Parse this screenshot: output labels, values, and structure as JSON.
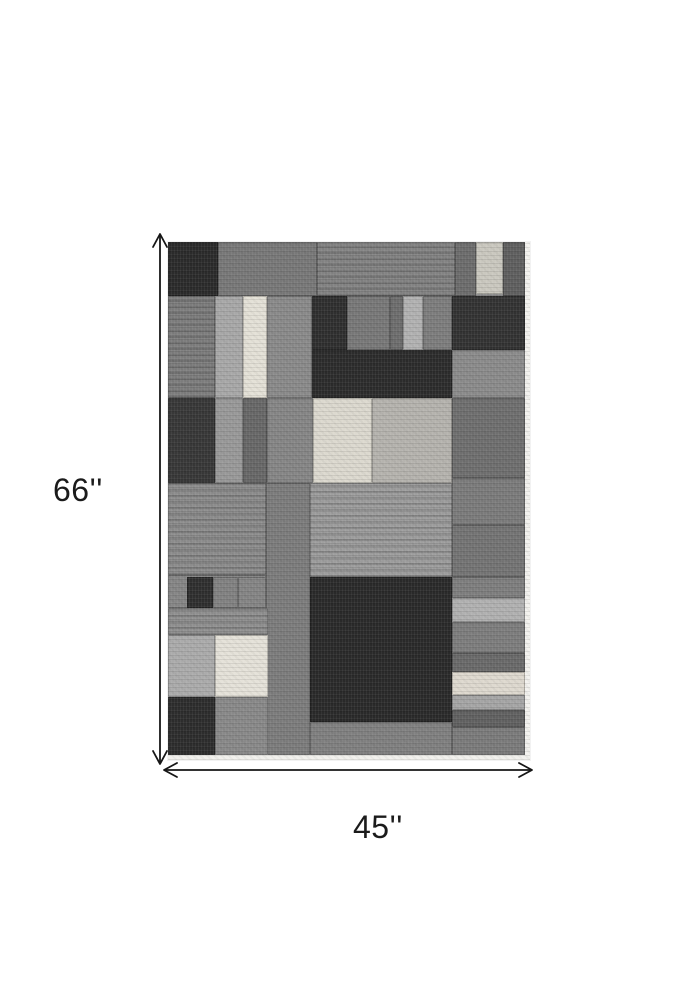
{
  "page": {
    "background": "#ffffff"
  },
  "dimensions": {
    "height_label": "66''",
    "width_label": "45''",
    "arrow_color": "#161616",
    "label_color": "#1b1b1b"
  },
  "product": {
    "description": "gray geometric patchwork area rug",
    "seam_color": "rgba(0,0,0,0.22)",
    "palette": {
      "charcoal": "#2b2b2b",
      "dark_gray": "#383838",
      "medium_gray": "#7d7d7d",
      "light_gray": "#b2b2b2",
      "ivory": "#e4e1d7",
      "binding_edge": "#f3f2ee"
    },
    "patches": [
      {
        "x": 0,
        "y": 0,
        "w": 50,
        "h": 54,
        "c": "#2b2b2b"
      },
      {
        "x": 50,
        "y": 0,
        "w": 99,
        "h": 54,
        "c": "#787878"
      },
      {
        "x": 149,
        "y": 0,
        "w": 138,
        "h": 54,
        "c": "#838383",
        "s": 1
      },
      {
        "x": 287,
        "y": 0,
        "w": 21,
        "h": 54,
        "c": "#6d6d6d"
      },
      {
        "x": 308,
        "y": 0,
        "w": 27,
        "h": 52,
        "c": "#cac8bf"
      },
      {
        "x": 335,
        "y": 0,
        "w": 22,
        "h": 54,
        "c": "#5f5f5f"
      },
      {
        "x": 0,
        "y": 54,
        "w": 47,
        "h": 102,
        "c": "#7d7d7d",
        "s": 1
      },
      {
        "x": 47,
        "y": 54,
        "w": 28,
        "h": 102,
        "c": "#a8a8a8"
      },
      {
        "x": 75,
        "y": 54,
        "w": 24,
        "h": 102,
        "c": "#e4e1d7"
      },
      {
        "x": 99,
        "y": 54,
        "w": 45,
        "h": 102,
        "c": "#8a8a8a"
      },
      {
        "x": 144,
        "y": 54,
        "w": 35,
        "h": 54,
        "c": "#2f2f2f"
      },
      {
        "x": 179,
        "y": 54,
        "w": 43,
        "h": 54,
        "c": "#787878"
      },
      {
        "x": 222,
        "y": 54,
        "w": 13,
        "h": 54,
        "c": "#6e6e6e"
      },
      {
        "x": 235,
        "y": 54,
        "w": 20,
        "h": 54,
        "c": "#b2b2b2"
      },
      {
        "x": 255,
        "y": 54,
        "w": 29,
        "h": 54,
        "c": "#7d7d7d"
      },
      {
        "x": 284,
        "y": 54,
        "w": 73,
        "h": 54,
        "c": "#333333"
      },
      {
        "x": 144,
        "y": 108,
        "w": 140,
        "h": 48,
        "c": "#2c2c2c"
      },
      {
        "x": 284,
        "y": 108,
        "w": 73,
        "h": 48,
        "c": "#8b8b8b"
      },
      {
        "x": 0,
        "y": 156,
        "w": 47,
        "h": 85,
        "c": "#383838"
      },
      {
        "x": 47,
        "y": 156,
        "w": 28,
        "h": 85,
        "c": "#999999"
      },
      {
        "x": 75,
        "y": 156,
        "w": 24,
        "h": 85,
        "c": "#686868"
      },
      {
        "x": 99,
        "y": 156,
        "w": 46,
        "h": 85,
        "c": "#868686"
      },
      {
        "x": 145,
        "y": 156,
        "w": 59,
        "h": 85,
        "c": "#dcd9cf"
      },
      {
        "x": 204,
        "y": 156,
        "w": 80,
        "h": 85,
        "c": "#b5b3ae"
      },
      {
        "x": 284,
        "y": 156,
        "w": 73,
        "h": 80,
        "c": "#6f6f6f"
      },
      {
        "x": 0,
        "y": 241,
        "w": 98,
        "h": 92,
        "c": "#8c8c8c",
        "s": 1
      },
      {
        "x": 98,
        "y": 241,
        "w": 44,
        "h": 272,
        "c": "#7c7c7c"
      },
      {
        "x": 142,
        "y": 241,
        "w": 142,
        "h": 94,
        "c": "#9c9c9c",
        "s": 1
      },
      {
        "x": 284,
        "y": 236,
        "w": 73,
        "h": 47,
        "c": "#7b7b7b"
      },
      {
        "x": 284,
        "y": 283,
        "w": 73,
        "h": 52,
        "c": "#747474"
      },
      {
        "x": 0,
        "y": 333,
        "w": 98,
        "h": 33,
        "c": "#868686"
      },
      {
        "x": 19,
        "y": 335,
        "w": 26,
        "h": 31,
        "c": "#2f2f2f"
      },
      {
        "x": 45,
        "y": 335,
        "w": 25,
        "h": 31,
        "c": "#828282"
      },
      {
        "x": 70,
        "y": 335,
        "w": 28,
        "h": 31,
        "c": "#858585"
      },
      {
        "x": 0,
        "y": 366,
        "w": 100,
        "h": 27,
        "c": "#8f8f8f",
        "s": 1
      },
      {
        "x": 0,
        "y": 393,
        "w": 47,
        "h": 62,
        "c": "#ababab"
      },
      {
        "x": 47,
        "y": 393,
        "w": 53,
        "h": 62,
        "c": "#e5e2d9"
      },
      {
        "x": 0,
        "y": 455,
        "w": 47,
        "h": 58,
        "c": "#2d2d2d"
      },
      {
        "x": 47,
        "y": 455,
        "w": 53,
        "h": 58,
        "c": "#898989"
      },
      {
        "x": 142,
        "y": 335,
        "w": 142,
        "h": 145,
        "c": "#2a2a2a"
      },
      {
        "x": 142,
        "y": 480,
        "w": 142,
        "h": 33,
        "c": "#808080"
      },
      {
        "x": 284,
        "y": 335,
        "w": 73,
        "h": 21,
        "c": "#7e7e7e"
      },
      {
        "x": 284,
        "y": 356,
        "w": 73,
        "h": 24,
        "c": "#b1b1b1"
      },
      {
        "x": 284,
        "y": 380,
        "w": 73,
        "h": 31,
        "c": "#7d7d7d"
      },
      {
        "x": 284,
        "y": 411,
        "w": 73,
        "h": 19,
        "c": "#6a6a6a"
      },
      {
        "x": 284,
        "y": 430,
        "w": 73,
        "h": 23,
        "c": "#ded9cf"
      },
      {
        "x": 284,
        "y": 453,
        "w": 73,
        "h": 15,
        "c": "#a5a5a5"
      },
      {
        "x": 284,
        "y": 468,
        "w": 73,
        "h": 17,
        "c": "#616161"
      },
      {
        "x": 284,
        "y": 485,
        "w": 73,
        "h": 28,
        "c": "#7b7b7b"
      }
    ],
    "edges": [
      {
        "x": 357,
        "y": 0,
        "w": 5,
        "h": 518,
        "c": "#f3f2ee"
      },
      {
        "x": 0,
        "y": 513,
        "w": 362,
        "h": 5,
        "c": "#f1f0ec"
      }
    ]
  }
}
